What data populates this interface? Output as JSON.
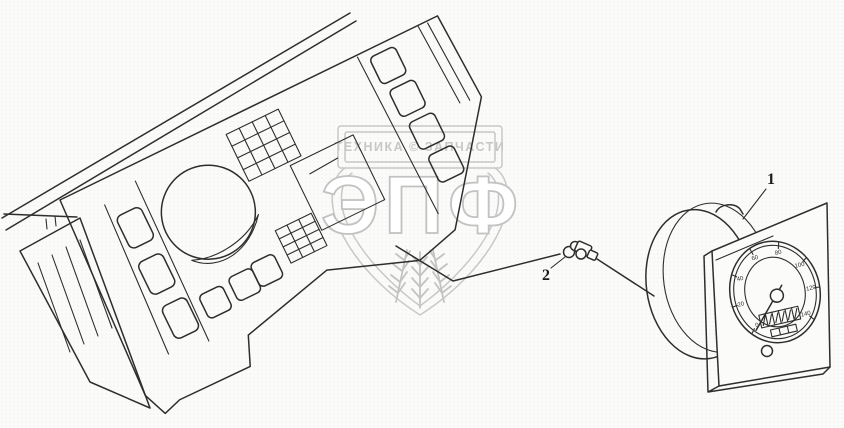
{
  "diagram": {
    "callouts": [
      {
        "label": "1"
      },
      {
        "label": "2"
      }
    ]
  },
  "watermark": {
    "banner_text": "ТЕХНИКА © ЗАПЧАСТИ",
    "monogram": "ЭПФ",
    "color": "#c8c8c8"
  },
  "speedometer": {
    "dial_labels": [
      "0",
      "20",
      "40",
      "60",
      "80",
      "100",
      "120",
      "140"
    ]
  },
  "colors": {
    "line": "#2e2e2e",
    "background": "#fbfbf9"
  }
}
